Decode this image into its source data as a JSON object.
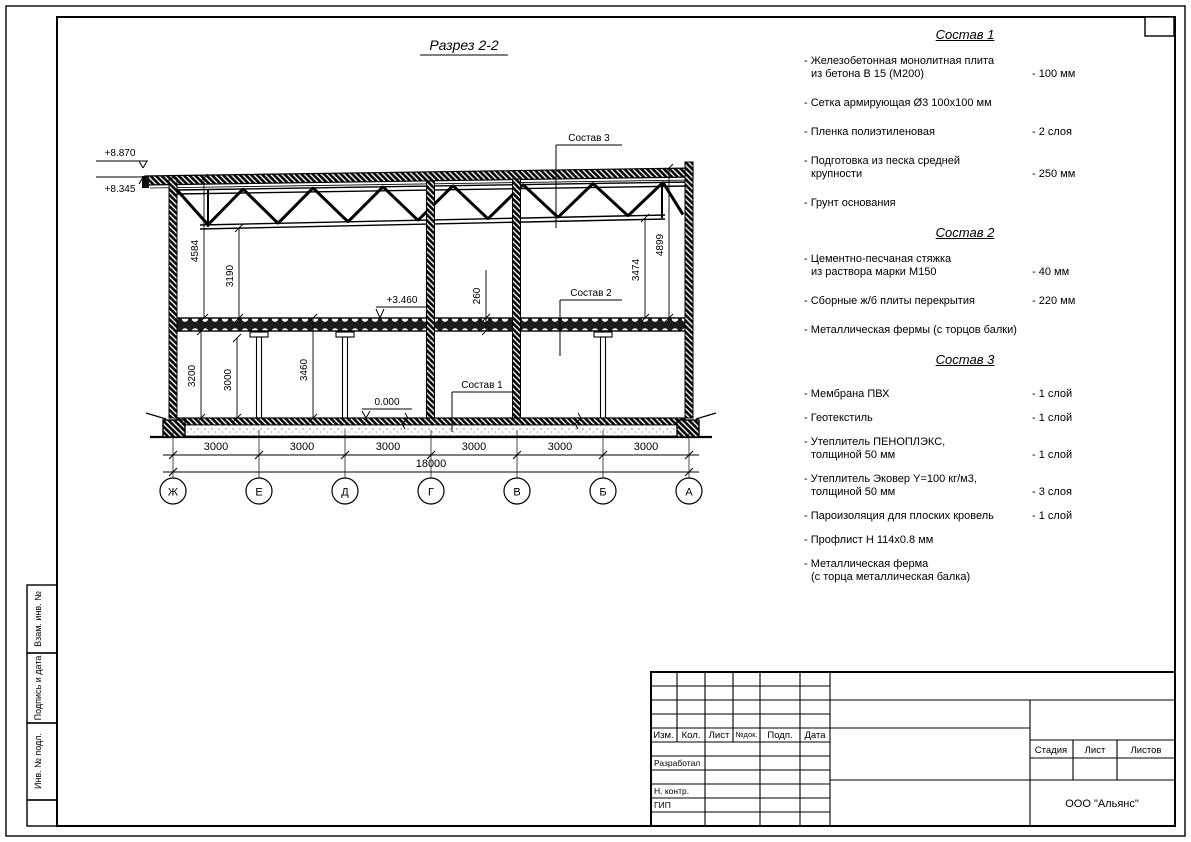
{
  "page": {
    "title_label": "Разрез 2-2"
  },
  "section": {
    "elevations": {
      "roof_high": "+8.870",
      "roof_low": "+8.345",
      "floor2": "+3.460",
      "zero": "0.000"
    },
    "leaders": {
      "s1": "Состав 1",
      "s2": "Состав 2",
      "s3": "Состав 3"
    },
    "dims": {
      "left_outer": "4584",
      "left_inner": "3190",
      "slab": "260",
      "right_inner": "3474",
      "right_outer": "4899",
      "f1_left": "3200",
      "f1_mid": "3000",
      "f1_right": "3460",
      "bay": "3000",
      "total": "18000"
    },
    "axes": [
      "Ж",
      "Е",
      "Д",
      "Г",
      "В",
      "Б",
      "А"
    ]
  },
  "compositions": [
    {
      "title": "Состав 1",
      "items": [
        {
          "lines": [
            "- Железобетонная монолитная плита",
            "из бетона В 15 (М200)"
          ],
          "value": "- 100 мм"
        },
        {
          "lines": [
            "- Сетка армирующая Ø3 100х100 мм"
          ],
          "value": ""
        },
        {
          "lines": [
            "- Пленка полиэтиленовая"
          ],
          "value": "- 2 слоя"
        },
        {
          "lines": [
            "- Подготовка из песка средней",
            "крупности"
          ],
          "value": "- 250 мм"
        },
        {
          "lines": [
            "- Грунт основания"
          ],
          "value": ""
        }
      ]
    },
    {
      "title": "Состав 2",
      "items": [
        {
          "lines": [
            "- Цементно-песчаная стяжка",
            "из раствора марки М150"
          ],
          "value": "- 40 мм"
        },
        {
          "lines": [
            "- Сборные ж/б плиты перекрытия"
          ],
          "value": "- 220 мм"
        },
        {
          "lines": [
            "- Металлическая фермы (с торцов балки)"
          ],
          "value": ""
        }
      ]
    },
    {
      "title": "Состав 3",
      "items": [
        {
          "lines": [
            "- Мембрана ПВХ"
          ],
          "value": "- 1 слой"
        },
        {
          "lines": [
            "- Геотекстиль"
          ],
          "value": "- 1 слой"
        },
        {
          "lines": [
            "- Утеплитель ПЕНОПЛЭКС,",
            "толщиной 50 мм"
          ],
          "value": "- 1 слой"
        },
        {
          "lines": [
            "- Утеплитель Эковер Y=100 кг/м3,",
            "толщиной 50 мм"
          ],
          "value": "- 3 слоя"
        },
        {
          "lines": [
            "- Пароизоляция для плоских кровель"
          ],
          "value": "- 1 слой"
        },
        {
          "lines": [
            "- Профлист Н 114х0.8 мм"
          ],
          "value": ""
        },
        {
          "lines": [
            "- Металлическая ферма",
            "(с торца металлическая балка)"
          ],
          "value": ""
        }
      ]
    }
  ],
  "titleblock": {
    "col_izm": "Изм.",
    "col_kol": "Кол.",
    "col_list": "Лист",
    "col_ndok": "№док.",
    "col_podp": "Подп.",
    "col_data": "Дата",
    "row_razrabotal": "Разработал",
    "row_nkontr": "Н. контр.",
    "row_gip": "ГИП",
    "stadia": "Стадия",
    "list": "Лист",
    "listov": "Листов",
    "org": "ООО \"Альянс\""
  },
  "side_strip": {
    "box1": "Взам. инв. №",
    "box2": "Подпись и дата",
    "box3": "Инв. № подл."
  },
  "colors": {
    "ink": "#000000",
    "paper": "#ffffff"
  }
}
